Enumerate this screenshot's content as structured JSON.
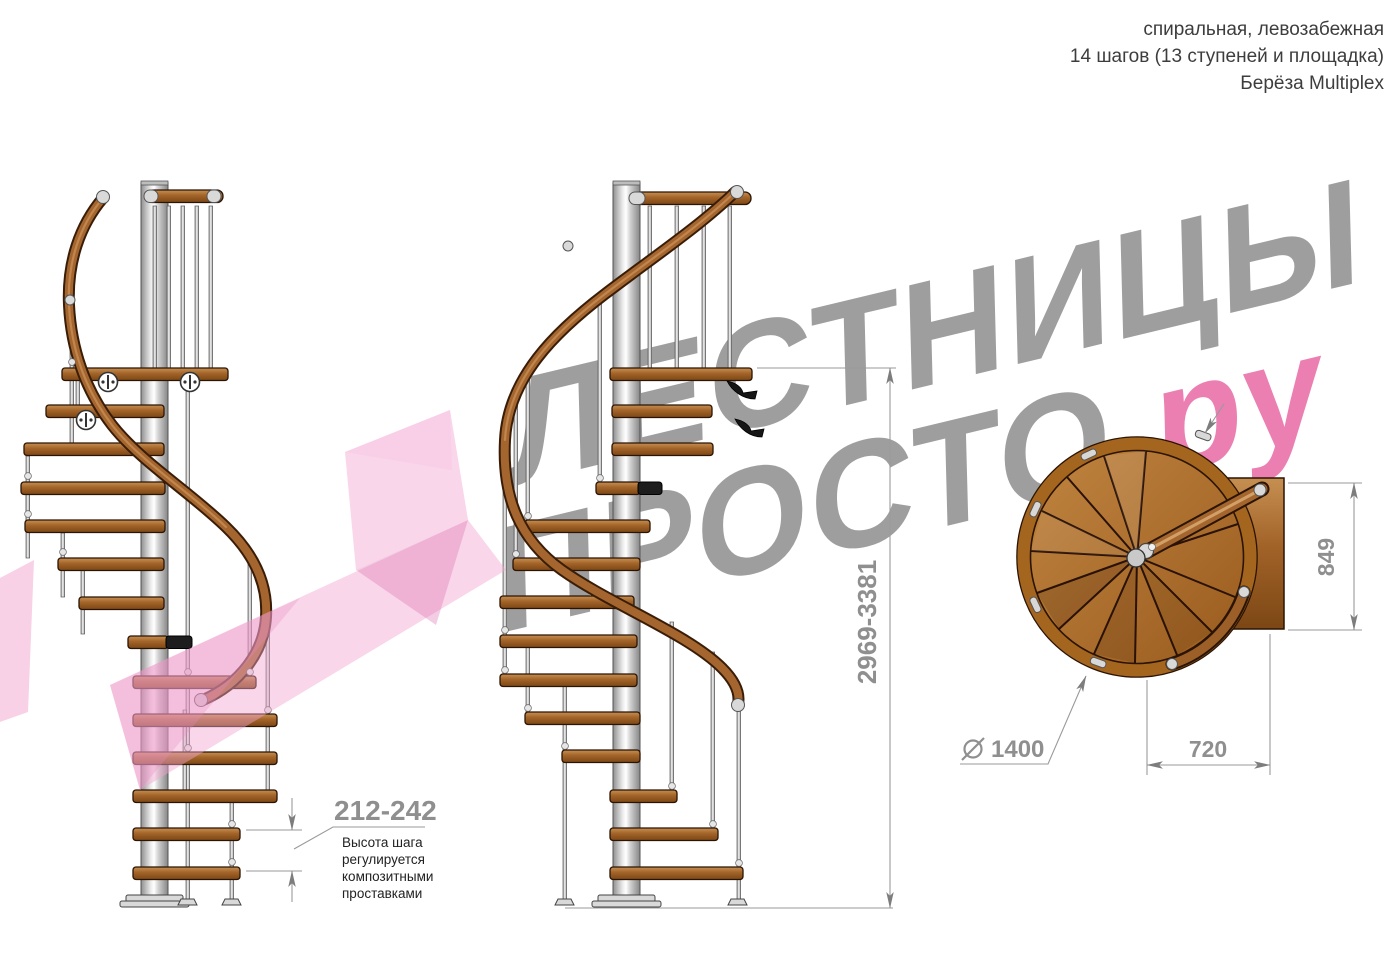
{
  "header": {
    "line1": "спиральная, левозабежная",
    "line2": "14 шагов (13 ступеней и площадка)",
    "line3": "Берёза Multiplex"
  },
  "watermark": {
    "word1": "ЛЕСТНИЦЫ",
    "word2": "ПРОСТО",
    "domain_suffix": ".ру"
  },
  "dimensions": {
    "total_height": "2969-3381",
    "step_height": "212-242",
    "note_lines": [
      "Высота шага",
      "регулируется",
      "композитными",
      "проставками"
    ],
    "landing_length": "849",
    "landing_width": "720",
    "diameter_symbol": "⌀",
    "diameter_value": "1400"
  },
  "colors": {
    "wood": "#a4662e",
    "metal": "#d9d9d9",
    "dimension_gray": "#8f8f8f",
    "watermark_gray": "#9e9e9e",
    "watermark_pink": "#ec7fb1",
    "arrow_pink": "#f2a3d0"
  }
}
